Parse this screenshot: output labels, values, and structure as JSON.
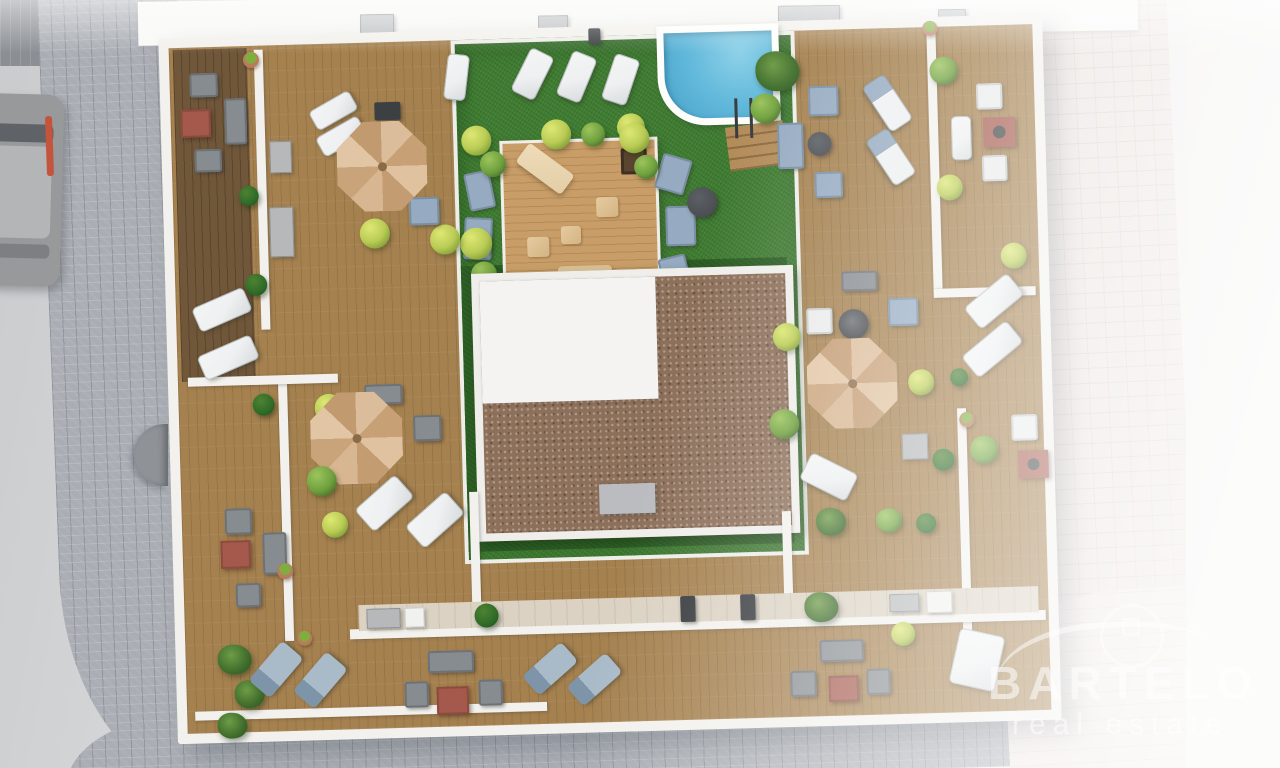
{
  "watermark": {
    "brand": "BARTELO",
    "tagline": "real estate",
    "logo": "house-swoosh-icon"
  },
  "palette": {
    "street-right": "#f2f1ef",
    "cobble": "#aaaeb4",
    "pink-paving": "#eae3e0",
    "wall": "#f2f1ed",
    "wood": "#a5814f",
    "wood-dark": "#70573a",
    "deck": "#c89d67",
    "turf": "#3f7d31",
    "turf-dark": "#2e6126",
    "pool": "#5fb7da",
    "gravel": "#8d705a",
    "roof-white": "#f4f3f1",
    "umbrella-a": "#dcbd9b",
    "umbrella-b": "#c8a076",
    "lounger": "#eef0f1",
    "cushion-blue": "#96abc1",
    "table-red": "#a4594c",
    "plant": "#6fa03e",
    "plant-yellow": "#bacc55",
    "bush": "#2f6b28",
    "car": "#98999b"
  },
  "inventory": {
    "parasols": 3,
    "sun_loungers": 19,
    "seating_groups": 7,
    "swimming_pool": 1,
    "central_timber_deck": 1,
    "gravel_roof_block": 1,
    "artificial_lawn": 1,
    "parked_car": 1
  }
}
